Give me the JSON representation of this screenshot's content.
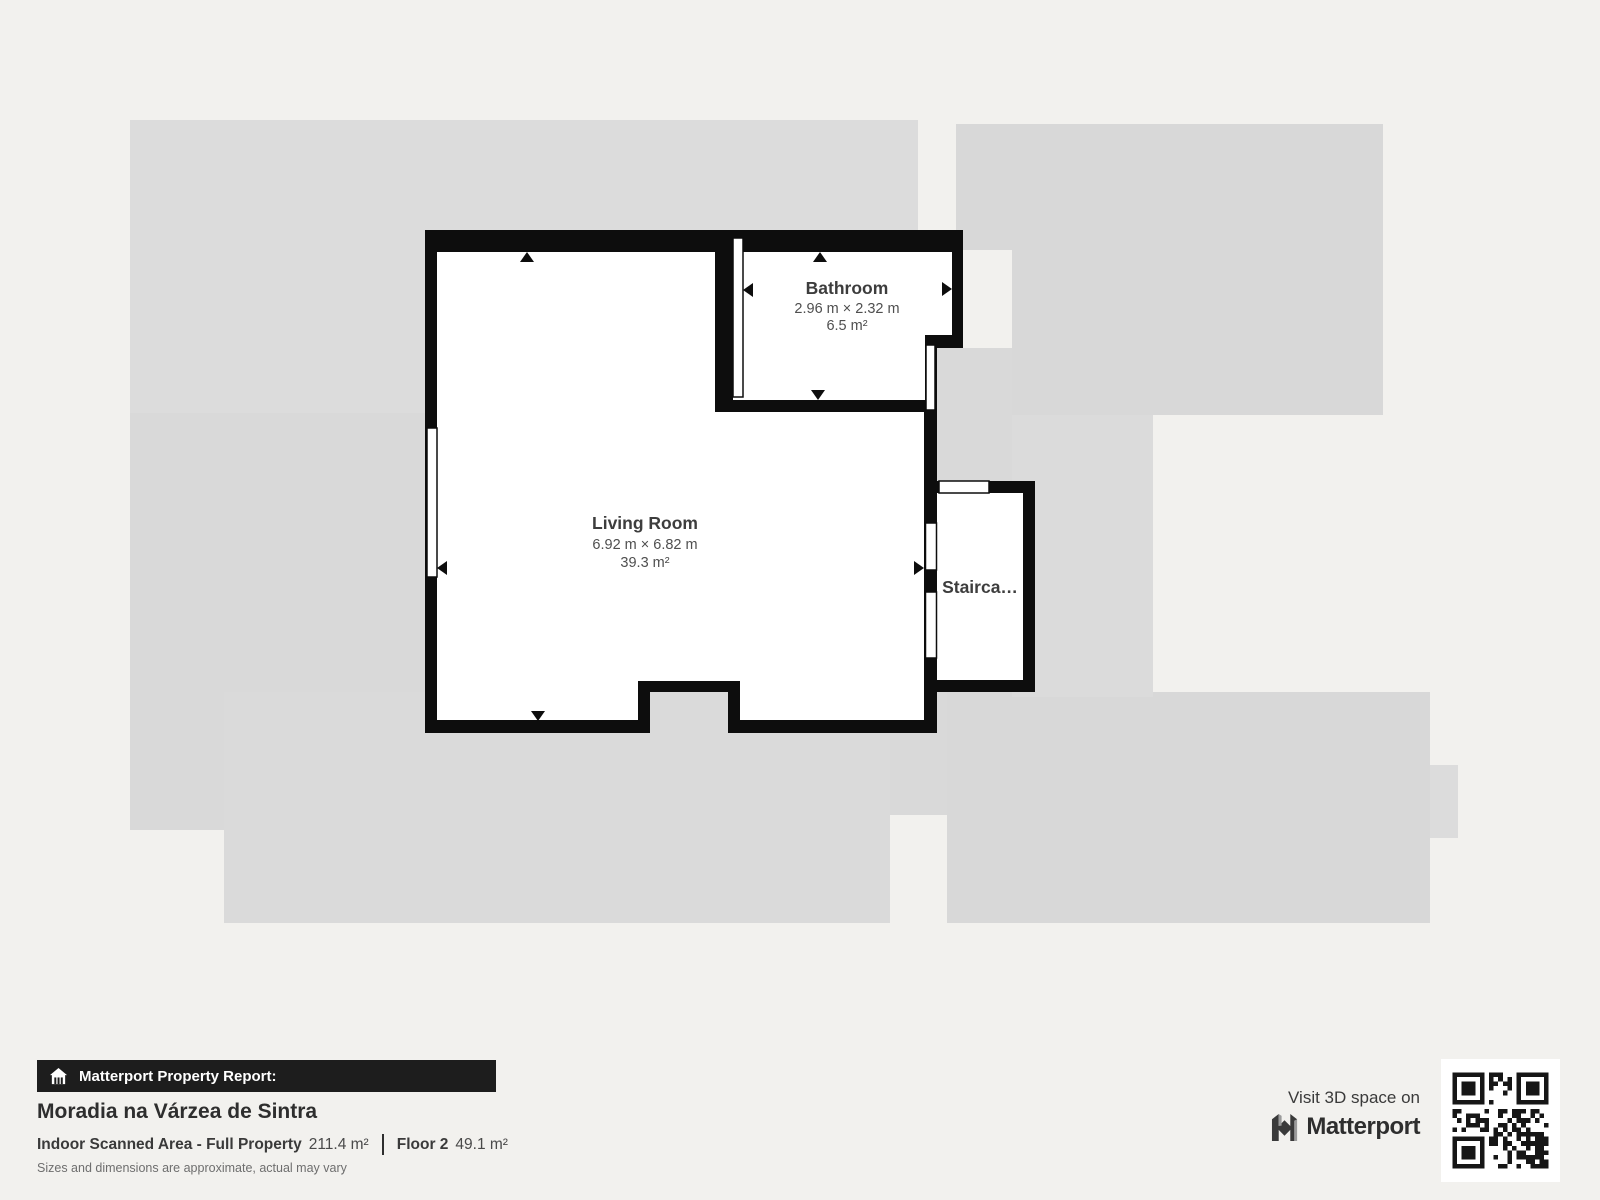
{
  "colors": {
    "page_bg": "#f2f1ee",
    "silhouette": "#d9d9d9",
    "wall": "#0d0d0d",
    "room_fill": "#ffffff",
    "label_title": "#3d3d3d",
    "footer_bar_bg": "#1d1d1d",
    "footer_bar_text": "#ffffff",
    "qr_dark": "#161616"
  },
  "floorplan": {
    "living_room": {
      "name": "Living Room",
      "dimensions": "6.92 m × 6.82 m",
      "area": "39.3 m²"
    },
    "bathroom": {
      "name": "Bathroom",
      "dimensions": "2.96 m × 2.32 m",
      "area": "6.5 m²"
    },
    "staircase": {
      "name": "Stairca…"
    }
  },
  "footer": {
    "report_label": "Matterport Property Report:",
    "property_name": "Moradia na Várzea de Sintra",
    "scanned_area_label": "Indoor Scanned Area - Full Property",
    "scanned_area_value": "211.4 m²",
    "floor_label": "Floor 2",
    "floor_value": "49.1 m²",
    "disclaimer": "Sizes and dimensions are approximate, actual may vary",
    "visit_label": "Visit 3D space on",
    "brand": "Matterport"
  }
}
